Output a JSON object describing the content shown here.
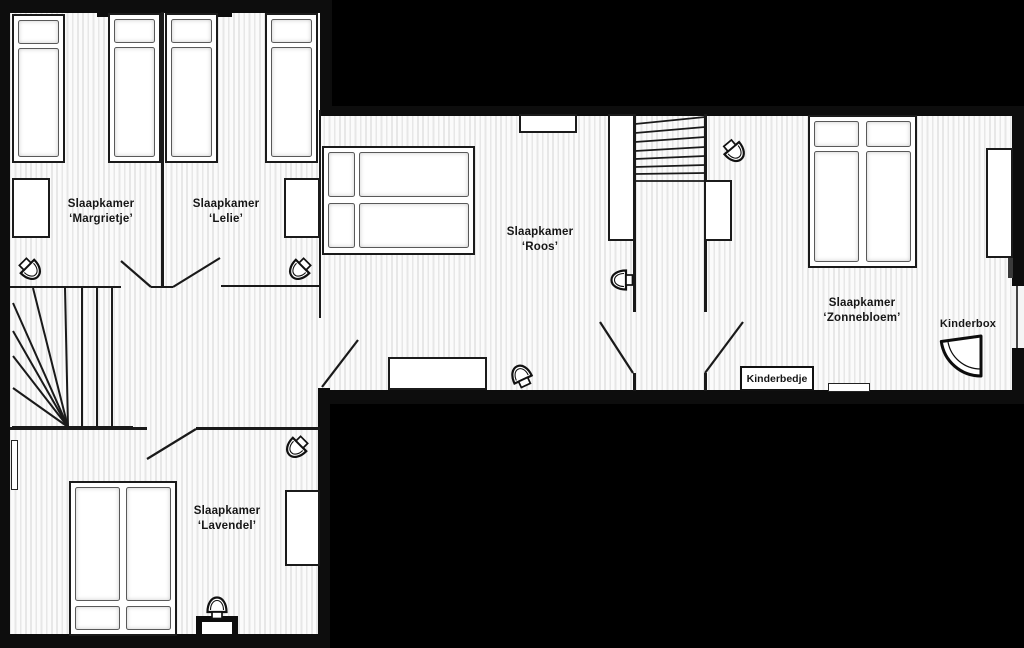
{
  "palette": {
    "background": "#000000",
    "floor": "#fbfbfb",
    "floor_stripe": "#e7e7e7",
    "wall": "#0d0d0d",
    "line": "#1a1a1a",
    "text": "#161616"
  },
  "rooms": {
    "margrietje": {
      "line1": "Slaapkamer",
      "line2": "‘Margrietje’"
    },
    "lelie": {
      "line1": "Slaapkamer",
      "line2": "‘Lelie’"
    },
    "roos": {
      "line1": "Slaapkamer",
      "line2": "‘Roos’"
    },
    "zonnebloem": {
      "line1": "Slaapkamer",
      "line2": "‘Zonnebloem’"
    },
    "lavendel": {
      "line1": "Slaapkamer",
      "line2": "‘Lavendel’"
    }
  },
  "items": {
    "kinderbox": {
      "label": "Kinderbox"
    },
    "kinderbedje": {
      "label": "Kinderbedje"
    }
  }
}
